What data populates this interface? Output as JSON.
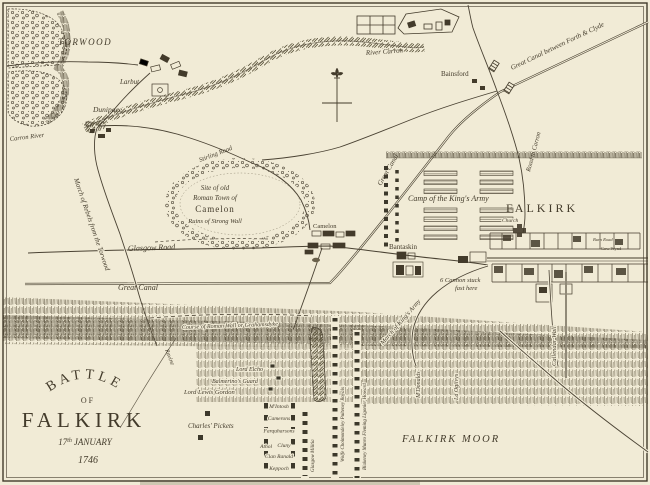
{
  "map": {
    "title": {
      "line1": "BATTLE",
      "line2": "OF",
      "line3": "FALKIRK",
      "date_num": "17",
      "date_sup": "th",
      "date_month": "JANUARY",
      "year": "1746"
    },
    "places": {
      "torwood": "TORWOOD",
      "larbert": "Larbut",
      "dunipace": "Dunipace",
      "carron_river": "Carron River",
      "river_carron": "River Carron",
      "bainsford": "Bainsford",
      "camelon_village": "Camelon",
      "falkirk": "FALKIRK",
      "church": "Church",
      "bantaskin": "Bantaskin",
      "falkirk_moor": "FALKIRK MOOR",
      "burn_road": "Burn Road",
      "cow_wynd": "Cow Wynd"
    },
    "routes": {
      "great_canal_full": "Great Canal between Forth & Clyde",
      "great_canal_diag": "Great Canal",
      "great_canal_west": "Great Canal",
      "glasgow_road": "Glasgow Road",
      "stirling_road": "Stirling Road",
      "road_to_carron": "Road to Carron",
      "callendar_wall": "Callendar Wall",
      "roman_wall": "Course of Roman Wall or Grahamsdyke",
      "march_rebels": "March of Rebels from the Torwood",
      "march_kings": "March of King's Army",
      "ravine": "Ravine"
    },
    "camelon_site": {
      "l1": "Site of old",
      "l2": "Roman Town of",
      "l3": "Camelon",
      "l4": "Ruins of Strong Wall"
    },
    "annotations": {
      "camp": "Camp of the King's Army",
      "cannon_l1": "6 Cannon stuck",
      "cannon_l2": "fast here",
      "charles_pickets": "Charles' Pickets"
    },
    "jacobite": {
      "athol": "Athol",
      "clans": [
        "M'Intosh",
        "Camerons",
        "Farquharsons",
        "Cluny",
        "Clan Ranald",
        "Keppoch"
      ],
      "second_line": [
        "Lord Elcho",
        "Balmerino's Guard",
        "Lord Lewis Gordon"
      ],
      "right_wing": [
        "M'Donalds",
        "Ld Ogilvys"
      ]
    },
    "government": {
      "line1": "Wolfe Cholmondeley Pulteney Royals",
      "line2": "Blakeney Munro Fleming Ligonier Howard",
      "militia": "Glasgow Militia"
    },
    "colors": {
      "paper": "#f1ebd6",
      "ink": "#433b2b",
      "hatch": "#6a614b"
    }
  }
}
